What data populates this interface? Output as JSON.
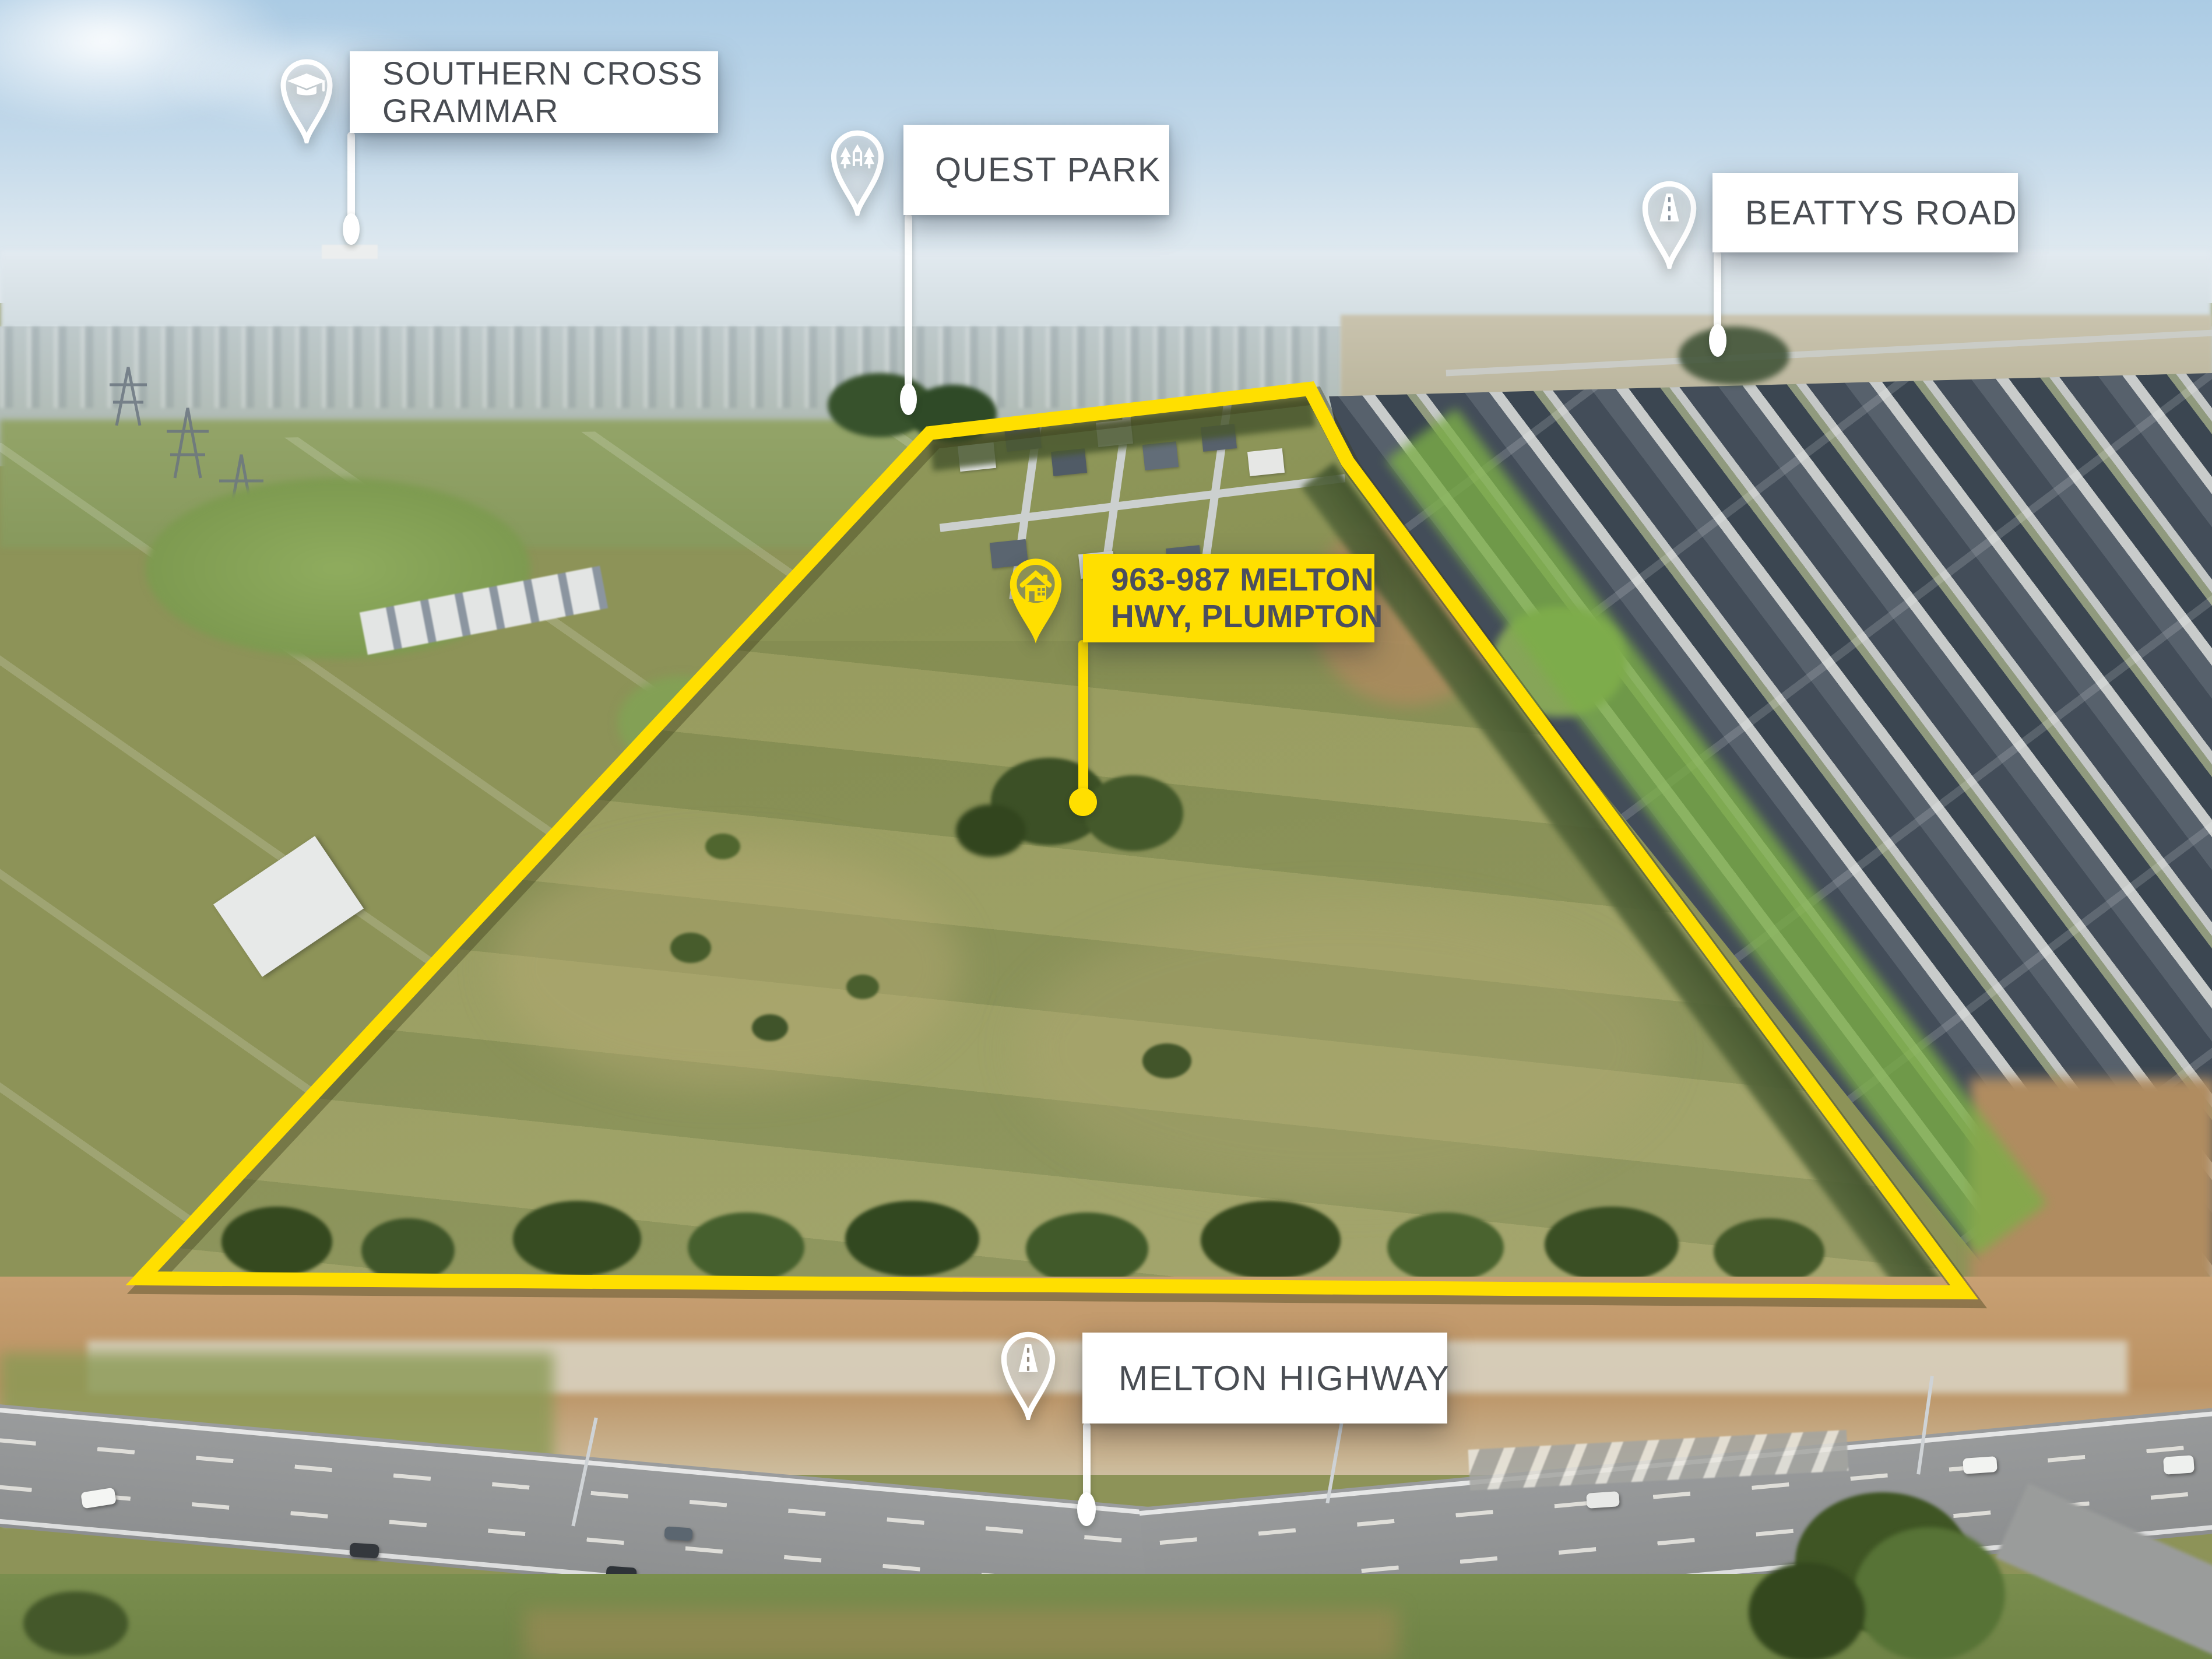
{
  "callouts": {
    "school": {
      "line1": "SOUTHERN CROSS",
      "line2": "GRAMMAR",
      "icon": "graduation-cap-icon"
    },
    "park": {
      "label": "QUEST PARK",
      "icon": "park-trees-icon"
    },
    "road_north": {
      "label": "BEATTYS ROAD",
      "icon": "road-icon"
    },
    "property": {
      "line1": "963-987 MELTON",
      "line2": "HWY, PLUMPTON",
      "icon": "house-icon"
    },
    "highway_south": {
      "label": "MELTON HIGHWAY",
      "icon": "road-icon"
    }
  },
  "colors": {
    "accent_yellow": "#FFDF00",
    "callout_bg": "#FFFFFF",
    "callout_text": "#494D53",
    "property_callout_text": "#4A4E5F"
  },
  "boundary": {
    "style": "yellow-outline",
    "color": "#FFDF00"
  }
}
